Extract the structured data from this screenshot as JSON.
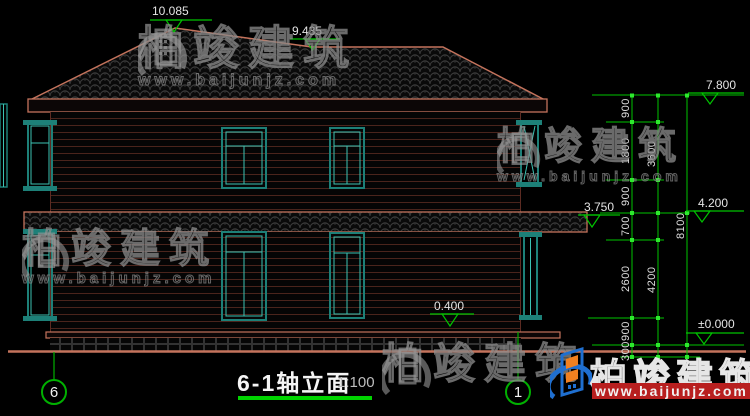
{
  "drawing": {
    "title": "6-1轴立面",
    "scale": "1:100",
    "axis_left": "6",
    "axis_right": "1"
  },
  "levels": {
    "ridge": "10.085",
    "secondary_ridge": "9.435",
    "eave": "7.800",
    "floor2": "4.200",
    "canopy": "3.750",
    "sill": "0.400",
    "ground": "±0.000"
  },
  "dimensions": {
    "col1": [
      "900",
      "1800",
      "900",
      "700",
      "2600",
      "900",
      "300"
    ],
    "col2": [
      "3600",
      "4200"
    ],
    "col3": [
      "8100"
    ]
  },
  "watermark": {
    "brand": "柏竣建筑",
    "url": "www.baijunjz.com"
  },
  "colors": {
    "background": "#000000",
    "outline_salmon": "#c4735c",
    "wall_line": "#4a241c",
    "window_frame_teal": "#1d8078",
    "window_inner_cyan": "#3cc2b2",
    "dimension_green": "#00c400",
    "tick_green": "#2ee82e",
    "underline_green": "#00d400",
    "logo_blue": "#1f6fd0",
    "logo_orange": "#f08020",
    "url_red": "#b81f1f",
    "text_white": "#e4e4e4"
  }
}
